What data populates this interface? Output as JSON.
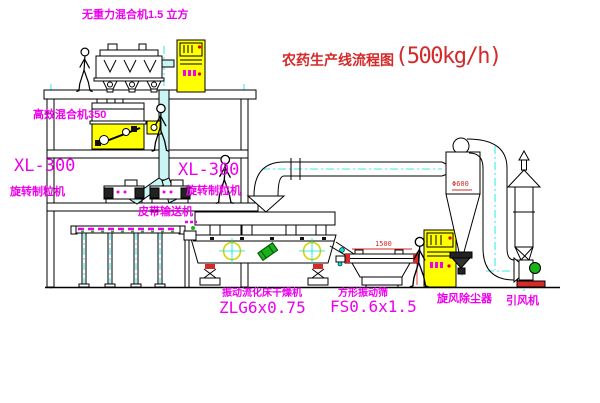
{
  "title": {
    "main": "农药生产线流程图",
    "capacity": "(500kg/h)"
  },
  "labels": {
    "top_mixer": "无重力混合机1.5 立方",
    "mixer2": "高效混合机350",
    "xl_model_left": "XL-300",
    "xl_name_left": "旋转制粒机",
    "xl_model_center": "XL-300",
    "xl_name_center": "旋转制粒机",
    "belt": "皮带输送机",
    "dryer_name": "振动流化床干燥机",
    "dryer_model": "ZLG6x0.75",
    "sieve_name": "方形振动筛",
    "sieve_model": "FS0.6x1.5",
    "cyclone": "旋风除尘器",
    "fan": "引风机"
  },
  "dims": {
    "cyclone_diameter": "Φ600",
    "sieve_length": "1500"
  },
  "colors": {
    "label_magenta": "#ee00ee",
    "title_red": "#d42a2a",
    "cabinet_yellow": "#ffff00",
    "centerline_cyan": "#00e0e0",
    "motor_green": "#19b219"
  }
}
